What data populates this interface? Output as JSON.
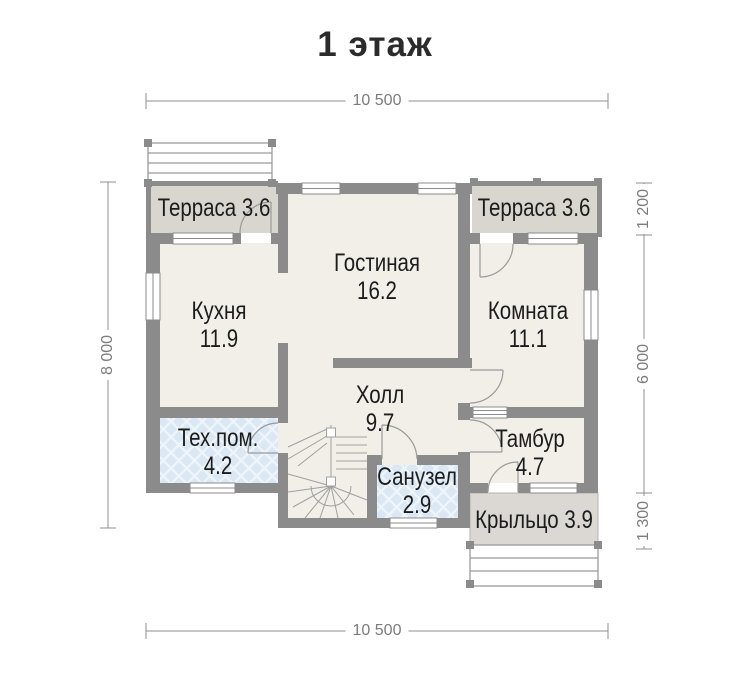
{
  "title": "1 этаж",
  "dimensions": {
    "top": "10 500",
    "bottom": "10 500",
    "left": "8 000",
    "right_top": "1 200",
    "right_middle": "6 000",
    "right_bottom": "1 300"
  },
  "rooms": [
    {
      "id": "terrace-left",
      "label": "Терраса 3.6"
    },
    {
      "id": "terrace-right",
      "label": "Терраса 3.6"
    },
    {
      "id": "living",
      "name": "Гостиная",
      "area": "16.2"
    },
    {
      "id": "kitchen",
      "name": "Кухня",
      "area": "11.9"
    },
    {
      "id": "room",
      "name": "Комната",
      "area": "11.1"
    },
    {
      "id": "hall",
      "name": "Холл",
      "area": "9.7"
    },
    {
      "id": "tech",
      "name": "Тех.пом.",
      "area": "4.2"
    },
    {
      "id": "tambour",
      "name": "Тамбур",
      "area": "4.7"
    },
    {
      "id": "bathroom",
      "name": "Санузел",
      "area": "2.9"
    },
    {
      "id": "porch",
      "label": "Крыльцо 3.9"
    }
  ],
  "colors": {
    "wall": "#8b8b8b",
    "room_floor": "#f2efe9",
    "terrace_floor": "#d9d5cf",
    "porch_floor": "#dbd8d4",
    "tile_floor": "#dbe8f4",
    "dimension": "#8f8f8f",
    "label_text": "#1c1c1c"
  }
}
